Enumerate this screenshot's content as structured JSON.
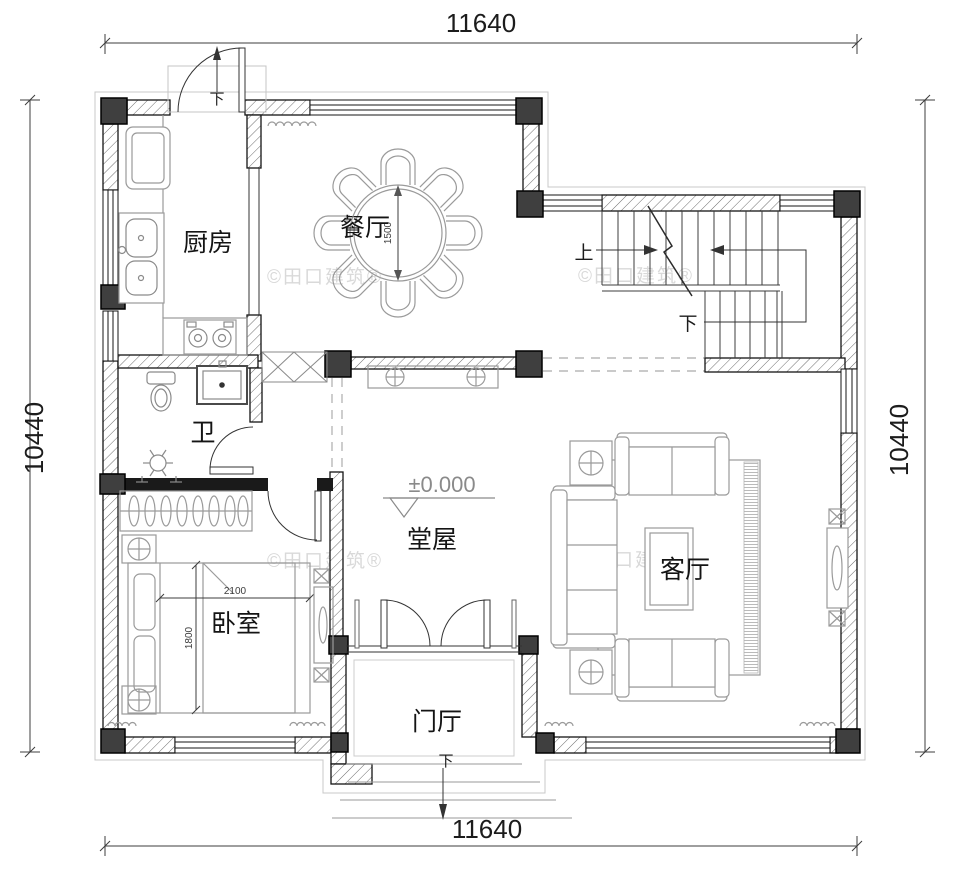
{
  "drawing": {
    "watermark": "©田口建筑®",
    "elevation_marker": "±0.000"
  },
  "dimensions": {
    "top": "11640",
    "bottom": "11640",
    "left": "10440",
    "right": "10440",
    "dining_table_diameter": "1500",
    "bed_length": "2100",
    "bed_width": "1800"
  },
  "rooms": {
    "dining": "餐厅",
    "kitchen": "厨房",
    "bath": "卫",
    "bedroom": "卧室",
    "hall": "堂屋",
    "living": "客厅",
    "foyer": "门厅"
  },
  "stairs": {
    "up": "上",
    "down": "下"
  },
  "steps": {
    "kitchen_door": "下",
    "foyer_door": "下"
  },
  "colors": {
    "wall_line": "#141414",
    "column_fill": "#3f3f3f",
    "furniture_line": "#9a9a9a",
    "watermark_gray": "#d9d9d9"
  }
}
